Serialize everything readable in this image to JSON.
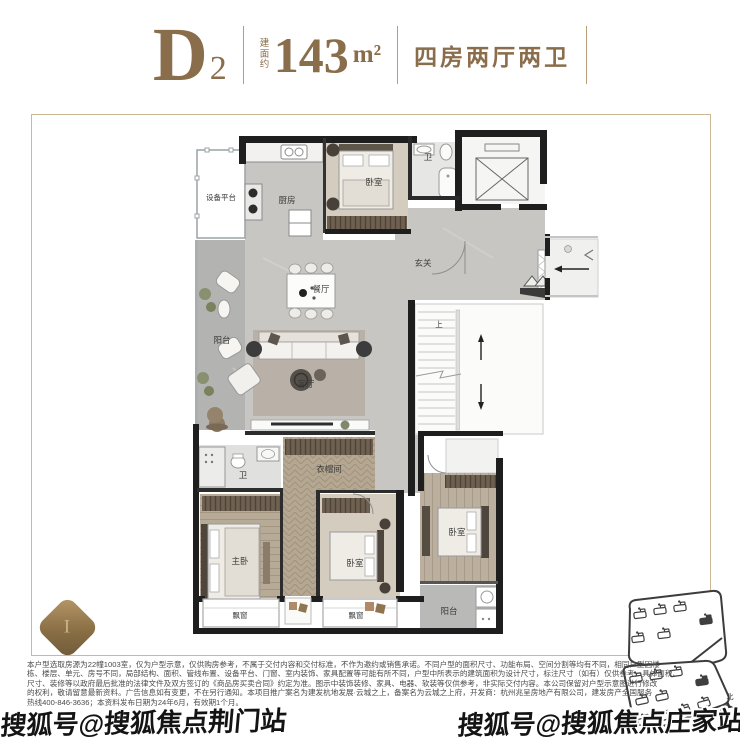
{
  "header": {
    "unit": "D",
    "unit_sub": "2",
    "area_prefix": "建面约",
    "area_value": "143",
    "area_unit": "m²",
    "layout": "四房两厅两卫"
  },
  "floorplan": {
    "rooms": {
      "equipment_platform": "设备平台",
      "kitchen": "厨房",
      "bedroom_top": "卧室",
      "bath_top": "卫",
      "foyer": "玄关",
      "dining": "餐厅",
      "living": "客厅",
      "balcony_left": "阳台",
      "bath_mid": "卫",
      "cloakroom": "衣帽间",
      "master_bedroom": "主卧",
      "bedroom_bottom": "卧室",
      "bedroom_right": "卧室",
      "balcony_bottom": "阳台",
      "stairs_up": "上",
      "bay_window_1": "飘窗",
      "bay_window_2": "飘窗"
    }
  },
  "badge_glyph": "I",
  "site_plan": {
    "north_label": "北"
  },
  "disclaimer": {
    "lines": [
      "本户型选取房源为22幢1003室，仅为户型示意，仅供购房参考，不属于交付内容和交付标准，不作为邀约或销售承诺。不同户型的面积尺寸、功能布局、空间分割等均有不同，相同户型因楼",
      "栋、楼层、单元、房号不同，局部结构、面积、管线布置、设备平台、门窗、室内装饰、家具配置等可能有所不同，户型中所表示的建筑面积为设计尺寸，标注尺寸（如有）仅供参考，具体面积、",
      "尺寸、装修等以政府最后批准的法律文件及双方签订的《商品房买卖合同》约定为准。图示中装饰装修、家具、电器、软装等仅供参考，非实际交付内容。本公司保留对户型示意图进行修改",
      "的权利，敬请留意最新资料。广告信息如有变更，不在另行通知。本项目推广案名为建发杭地发展·云城之上，备案名为云城之上府，开发商：杭州兆呈房地产有限公司，建发房产全国服务",
      "热线400-846-3636；本资料发布日期为24年6月，有效期1个月。"
    ]
  },
  "watermarks": {
    "bottom_left": "搜狐号@搜狐焦点荆门站",
    "bottom_right": "搜狐号@搜狐焦点庄家站"
  },
  "colors": {
    "accent": "#8a6d4a",
    "frame_border": "#cbb894",
    "wall": "#1e1e1e"
  }
}
